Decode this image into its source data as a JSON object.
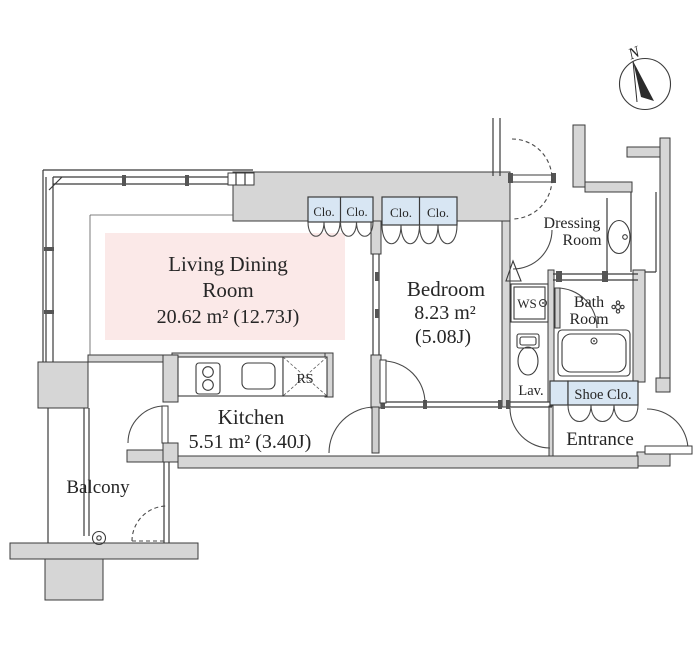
{
  "plan": {
    "compass": {
      "north_label": "N"
    },
    "rooms": {
      "living": {
        "line1": "Living Dining",
        "line2": "Room",
        "area": "20.62 m² (12.73J)"
      },
      "bedroom": {
        "name": "Bedroom",
        "area": "8.23 m²",
        "area2": "(5.08J)"
      },
      "kitchen": {
        "name": "Kitchen",
        "area": "5.51 m² (3.40J)"
      },
      "balcony": {
        "name": "Balcony"
      },
      "dressing": {
        "line1": "Dressing",
        "line2": "Room"
      },
      "bath": {
        "line1": "Bath",
        "line2": "Room"
      },
      "entrance": {
        "name": "Entrance"
      },
      "shoe_closet": {
        "name": "Shoe Clo."
      },
      "lavatory": {
        "name": "Lav."
      },
      "washer_space": {
        "name": "WS"
      },
      "range_shaft": {
        "name": "RS"
      },
      "closets": [
        "Clo.",
        "Clo.",
        "Clo.",
        "Clo."
      ]
    },
    "colors": {
      "living_fill": "#fbe9e8",
      "closet_fill": "#d8e6f3",
      "wall_fill": "#d6d6d6",
      "line": "#3b3b3b"
    }
  }
}
